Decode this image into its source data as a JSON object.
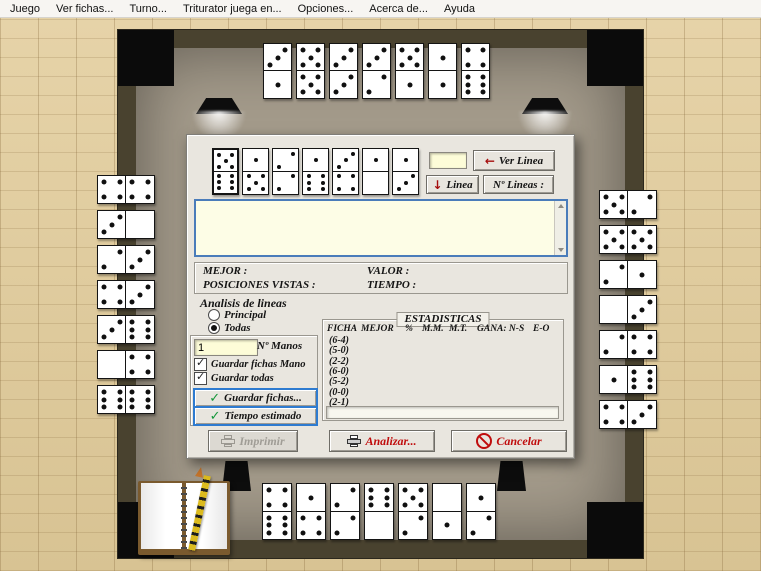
{
  "menu": {
    "items": [
      "Juego",
      "Ver fichas...",
      "Turno...",
      "Triturator juega en...",
      "Opciones...",
      "Acerca de...",
      "Ayuda"
    ]
  },
  "icons": {
    "back_arrow": "←",
    "down_arrow": "↓",
    "check": "✓"
  },
  "dialog": {
    "hand_tiles": [
      [
        5,
        6
      ],
      [
        1,
        5
      ],
      [
        2,
        2
      ],
      [
        1,
        6
      ],
      [
        3,
        4
      ],
      [
        1,
        0
      ],
      [
        1,
        3
      ]
    ],
    "line_input": {
      "value": ""
    },
    "buttons_top": {
      "ver_linea": "Ver Linea",
      "linea": "Linea",
      "num_lineas": "Nº Lineas :"
    },
    "memo": {
      "value": ""
    },
    "info": {
      "mejor_label": "MEJOR :",
      "valor_label": "VALOR :",
      "posiciones_label": "POSICIONES VISTAS :",
      "tiempo_label": "TIEMPO :"
    },
    "analysis": {
      "title": "Analisis de lineas",
      "options": [
        "Principal",
        "Todas"
      ],
      "selected": "Todas",
      "n_manos_value": "1",
      "n_manos_label": "Nº Manos",
      "checkboxes": [
        {
          "label": "Guardar fichas Mano",
          "checked": true
        },
        {
          "label": "Guardar todas",
          "checked": true
        }
      ],
      "save_button": "Guardar fichas...",
      "time_button": "Tiempo estimado"
    },
    "stats": {
      "title": "ESTADISTICAS",
      "headers": [
        "FICHA",
        "MEJOR",
        "%",
        "M.M.",
        "M.T.",
        "GANA: N-S",
        "E-O"
      ],
      "rows": [
        "(6-4)",
        "(5-0)",
        "(2-2)",
        "(6-0)",
        "(5-2)",
        "(0-0)",
        "(2-1)"
      ]
    },
    "actions": {
      "imprimir": "Imprimir",
      "analizar": "Analizar...",
      "cancelar": "Cancelar"
    }
  },
  "table": {
    "top_tiles": [
      [
        3,
        1
      ],
      [
        5,
        5
      ],
      [
        3,
        3
      ],
      [
        3,
        2
      ],
      [
        5,
        1
      ],
      [
        1,
        1
      ],
      [
        4,
        6
      ]
    ],
    "bottom_tiles": [
      [
        4,
        6
      ],
      [
        1,
        4
      ],
      [
        2,
        2
      ],
      [
        6,
        0
      ],
      [
        5,
        2
      ],
      [
        0,
        1
      ],
      [
        1,
        2
      ]
    ],
    "left_tiles": [
      [
        4,
        4
      ],
      [
        3,
        0
      ],
      [
        2,
        3
      ],
      [
        4,
        3
      ],
      [
        3,
        6
      ],
      [
        0,
        4
      ],
      [
        6,
        6
      ]
    ],
    "right_tiles": [
      [
        5,
        2
      ],
      [
        5,
        5
      ],
      [
        2,
        1
      ],
      [
        0,
        3
      ],
      [
        2,
        4
      ],
      [
        1,
        6
      ],
      [
        4,
        3
      ]
    ]
  },
  "colors": {
    "accent_blue": "#2e7bd0",
    "action_red": "#c00d0d",
    "check_green": "#15973a",
    "memo_yellow": "#fdfde6",
    "field_yellow": "#fdfcd8",
    "felt": "#a49b8b",
    "frame": "#49422f"
  }
}
